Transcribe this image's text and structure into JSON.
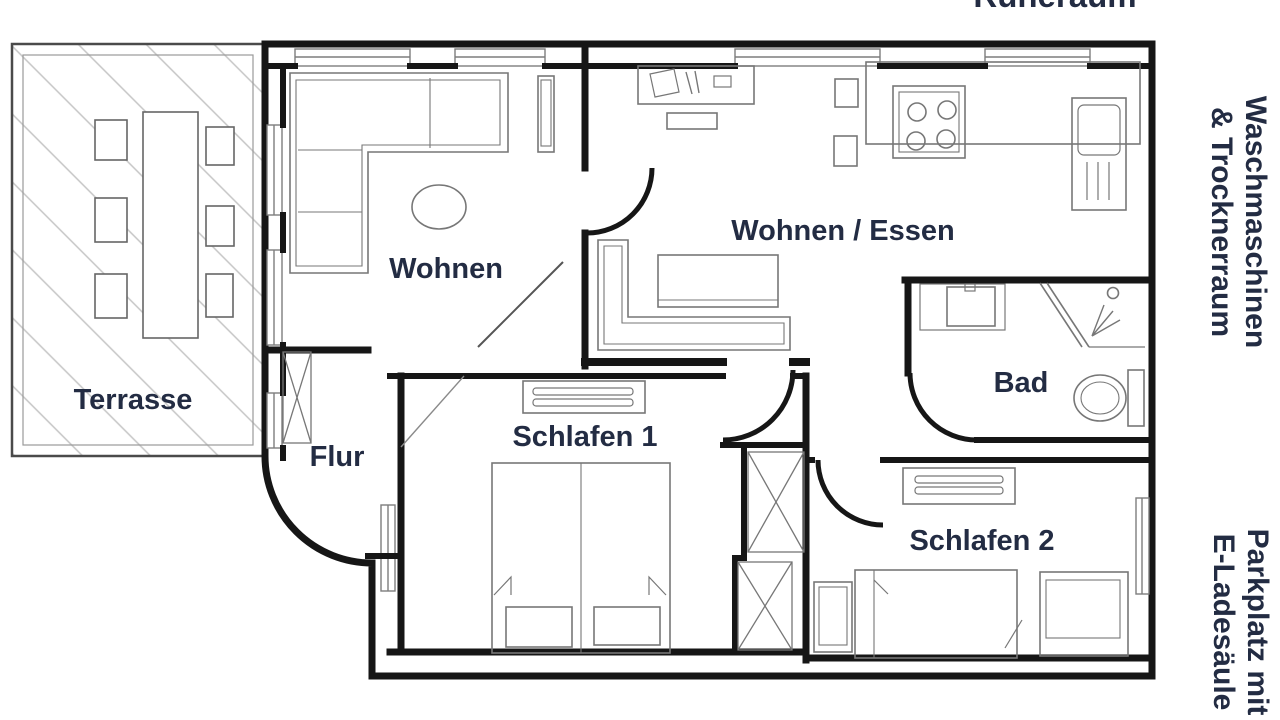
{
  "colors": {
    "label_navy": "#232c43",
    "wall_black": "#161616",
    "furniture_gray": "#777777",
    "hatch_gray": "#c5c5c5"
  },
  "cutoff_top_label": "Ruheraum",
  "margin_labels": {
    "laundry_line1": "Waschmaschinen",
    "laundry_line2": "& Trocknerraum",
    "parking_line1": "Parkplatz mit",
    "parking_line2": "E-Ladesäule"
  },
  "rooms": {
    "terrace": "Terrasse",
    "living": "Wohnen",
    "living_dining": "Wohnen / Essen",
    "hall": "Flur",
    "bedroom1": "Schlafen 1",
    "bedroom2": "Schlafen 2",
    "bath": "Bad"
  }
}
